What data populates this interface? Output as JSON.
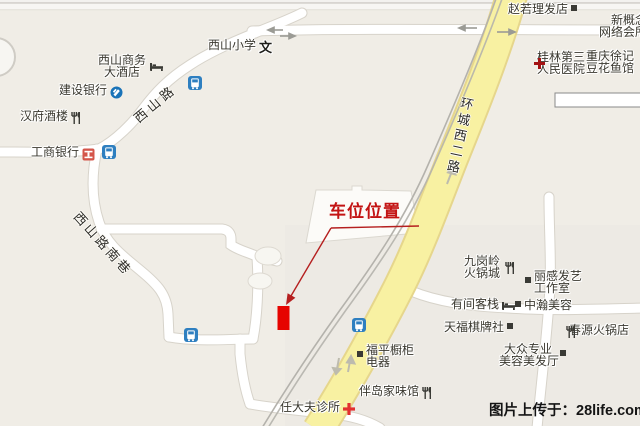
{
  "map": {
    "background": "#f0ede6",
    "road_fill": "#ffffff",
    "road_casing": "#d7d3ca",
    "yellow_road_fill": "#f8f1a2",
    "yellow_road_casing": "#e6d68c",
    "railway_color": "#b4b2ac",
    "poi_text_color": "#3a382f",
    "annotation_red": "#c31414",
    "marker_red": "#e60400",
    "bus_blue": "#2e7fc0"
  },
  "road_labels": [
    {
      "name": "xishan-road",
      "text": "西山路"
    },
    {
      "name": "xishan-road-south-lane",
      "text": "西山路南巷"
    },
    {
      "name": "huancheng-west-2nd-road",
      "text": "环城西二路"
    }
  ],
  "pois": [
    {
      "name": "xishan-business-hotel",
      "lines": [
        "西山商务",
        "大酒店"
      ],
      "icon": "hotel",
      "icon_pos": "right",
      "x": 97,
      "y": 55,
      "w": 50,
      "align": "center"
    },
    {
      "name": "ccb-bank",
      "lines": [
        "建设银行"
      ],
      "icon": "ccb",
      "icon_pos": "right",
      "x": 59,
      "y": 85
    },
    {
      "name": "hanfu-restaurant",
      "lines": [
        "汉府酒楼"
      ],
      "icon": "restaurant",
      "icon_pos": "right",
      "x": 20,
      "y": 111
    },
    {
      "name": "icbc-bank",
      "lines": [
        "工商银行"
      ],
      "icon": "icbc",
      "icon_pos": "right",
      "x": 31,
      "y": 147
    },
    {
      "name": "xishan-primary-school",
      "lines": [
        "西山小学"
      ],
      "icon": "school",
      "icon_char": "文",
      "icon_pos": "right",
      "x": 208,
      "y": 40
    },
    {
      "name": "zhaoruo-barbershop",
      "lines": [
        "赵若理发店"
      ],
      "icon": "dot",
      "icon_pos": "right",
      "x": 508,
      "y": 4
    },
    {
      "name": "new-concept-internet-club",
      "lines": [
        "新概念",
        "网络会所"
      ],
      "icon": "none",
      "x": 599,
      "y": 15,
      "w": 48,
      "align": "right"
    },
    {
      "name": "guilin-third-peoples-hospital",
      "lines": [
        "桂林第三",
        "人民医院"
      ],
      "icon": "cross-dark",
      "icon_pos": "left",
      "x": 537,
      "y": 52
    },
    {
      "name": "chongqing-xuji-douhua-fish",
      "lines": [
        "重庆徐记",
        "豆花鱼馆"
      ],
      "icon": "none",
      "x": 586,
      "y": 51
    },
    {
      "name": "jiugangling-hotpot-city",
      "lines": [
        "九岗岭",
        "火锅城"
      ],
      "icon": "restaurant",
      "icon_pos": "right",
      "x": 462,
      "y": 256,
      "w": 40,
      "align": "center"
    },
    {
      "name": "ligan-hair-art-studio",
      "lines": [
        "丽感发艺",
        "工作室"
      ],
      "icon": "dot",
      "icon_pos": "left",
      "x": 534,
      "y": 271
    },
    {
      "name": "youjian-inn",
      "lines": [
        "有间客栈"
      ],
      "icon": "hotel",
      "icon_pos": "right",
      "x": 451,
      "y": 299
    },
    {
      "name": "zhonghan-beauty",
      "lines": [
        "中瀚美容"
      ],
      "icon": "dot",
      "icon_pos": "left",
      "x": 524,
      "y": 300
    },
    {
      "name": "tianfu-chess-club",
      "lines": [
        "天福棋牌社"
      ],
      "icon": "dot",
      "icon_pos": "right",
      "x": 444,
      "y": 322
    },
    {
      "name": "chunyuan-hotpot",
      "lines": [
        "春源火锅店"
      ],
      "icon": "restaurant",
      "icon_pos": "left",
      "x": 569,
      "y": 325
    },
    {
      "name": "dazhong-beauty-salon",
      "lines": [
        "大众专业",
        "美容美发厅"
      ],
      "icon": "dot",
      "icon_pos": "right",
      "x": 499,
      "y": 344,
      "w": 58,
      "align": "center"
    },
    {
      "name": "fuping-cabinet-appliance",
      "lines": [
        "福平橱柜",
        "电器"
      ],
      "icon": "dot",
      "icon_pos": "left",
      "x": 366,
      "y": 345
    },
    {
      "name": "bandao-home-restaurant",
      "lines": [
        "伴岛家味馆"
      ],
      "icon": "restaurant",
      "icon_pos": "right",
      "x": 359,
      "y": 386
    },
    {
      "name": "ren-doctor-clinic",
      "lines": [
        "任大夫诊所"
      ],
      "icon": "cross-red",
      "icon_pos": "right",
      "x": 280,
      "y": 402
    }
  ],
  "bus_stops": [
    {
      "x": 188,
      "y": 76
    },
    {
      "x": 102,
      "y": 145
    },
    {
      "x": 184,
      "y": 328
    },
    {
      "x": 352,
      "y": 318
    }
  ],
  "annotation": {
    "label": "车位位置"
  },
  "watermark": {
    "text": "图片上传于：28life.com"
  }
}
